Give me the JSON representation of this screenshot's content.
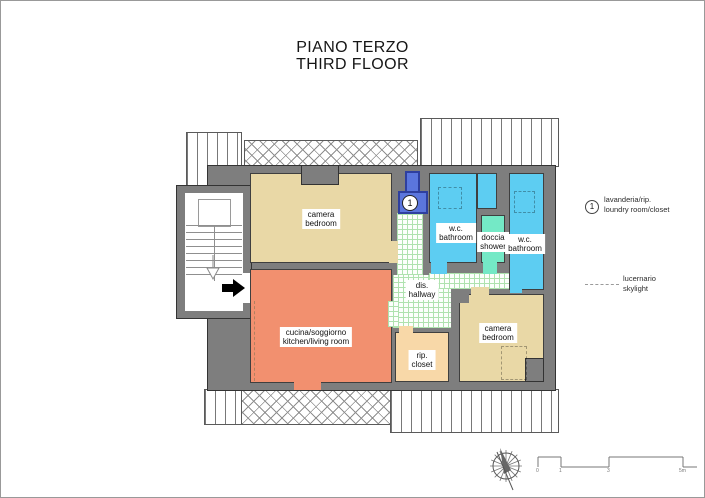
{
  "title": {
    "line1": "PIANO TERZO",
    "line2": "THIRD FLOOR"
  },
  "rooms": {
    "bedroom_top": {
      "it": "camera",
      "en": "bedroom"
    },
    "kitchen": {
      "it": "cucina/soggiorno",
      "en": "kitchen/living room"
    },
    "hallway": {
      "it": "dis.",
      "en": "hallway"
    },
    "bathroom_left": {
      "it": "w.c.",
      "en": "bathroom"
    },
    "shower": {
      "it": "doccia",
      "en": "shower"
    },
    "bathroom_right": {
      "it": "w.c.",
      "en": "bathroom"
    },
    "bedroom_bottom": {
      "it": "camera",
      "en": "bedroom"
    },
    "closet": {
      "it": "rip.",
      "en": "closet"
    }
  },
  "markers": {
    "laundry_number": "1"
  },
  "legend": {
    "laundry": {
      "symbol": "1",
      "it": "lavanderia/rip.",
      "en": "loundry room/closet"
    },
    "skylight": {
      "it": "lucernario",
      "en": "skylight"
    }
  },
  "scale_bar": {
    "tick0": "0",
    "tick1": "1",
    "tick2": "3",
    "tick3": "5m"
  },
  "colors": {
    "wall": "#7e7e7e",
    "bedroom": "#e9d8a6",
    "kitchen": "#f2906f",
    "bathroom": "#5dcdf2",
    "shower": "#74e9c6",
    "laundry": "#5b76dd",
    "closet": "#f8d8a8"
  }
}
